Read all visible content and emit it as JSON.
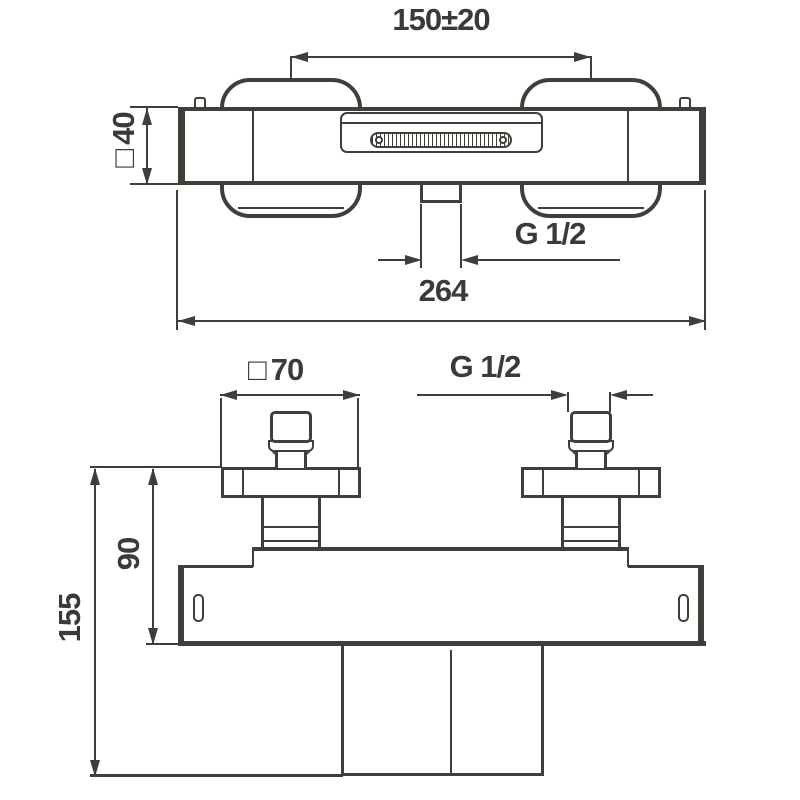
{
  "colors": {
    "line": "#3f3f3a",
    "text": "#3a3a3a",
    "background": "#ffffff"
  },
  "views": {
    "top": {
      "dims": {
        "handle_spacing": "150±20",
        "square_symbol": "□",
        "body_square": "40",
        "outlet_thread": "G 1/2",
        "overall_width": "264"
      }
    },
    "front": {
      "dims": {
        "square_symbol": "□",
        "handle_square": "70",
        "inlet_thread": "G 1/2",
        "body_height": "90",
        "overall_height": "155"
      }
    }
  }
}
